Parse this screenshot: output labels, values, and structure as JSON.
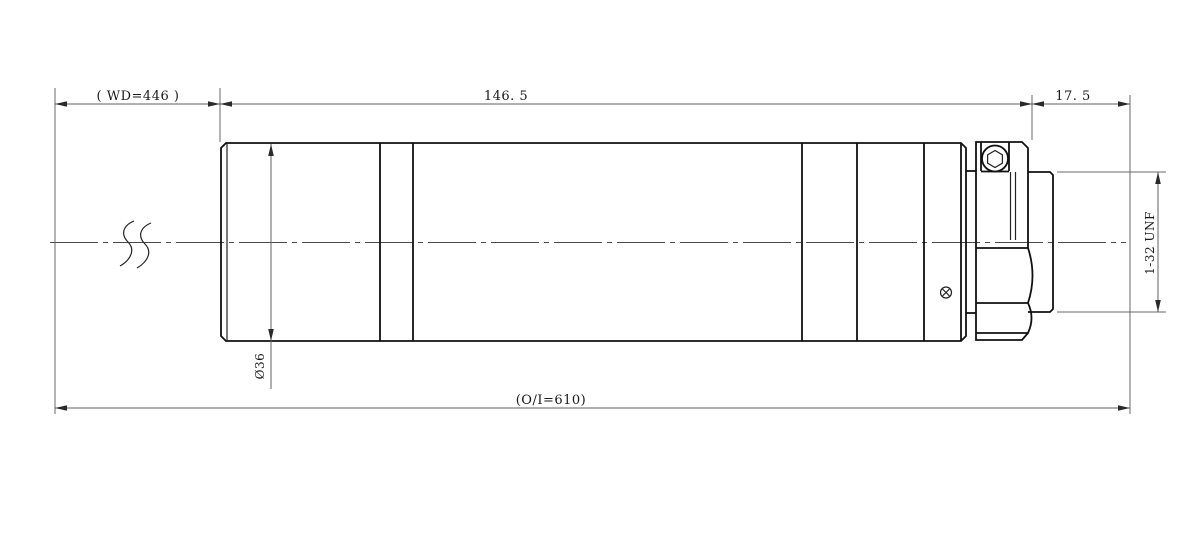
{
  "drawing": {
    "kind": "cylindrical lens / borescope side-view technical drawing",
    "dimensions": {
      "working_distance": "( WD=446 )",
      "body_length": "146. 5",
      "flange_offset": "17. 5",
      "overall_length": "(O/I=610)",
      "body_diameter": "Ø36",
      "mount_thread": "1-32 UNF"
    },
    "colors": {
      "outline": "#111111",
      "dimension_line": "#606060",
      "text": "#1a1a1a",
      "background": "#ffffff"
    }
  }
}
